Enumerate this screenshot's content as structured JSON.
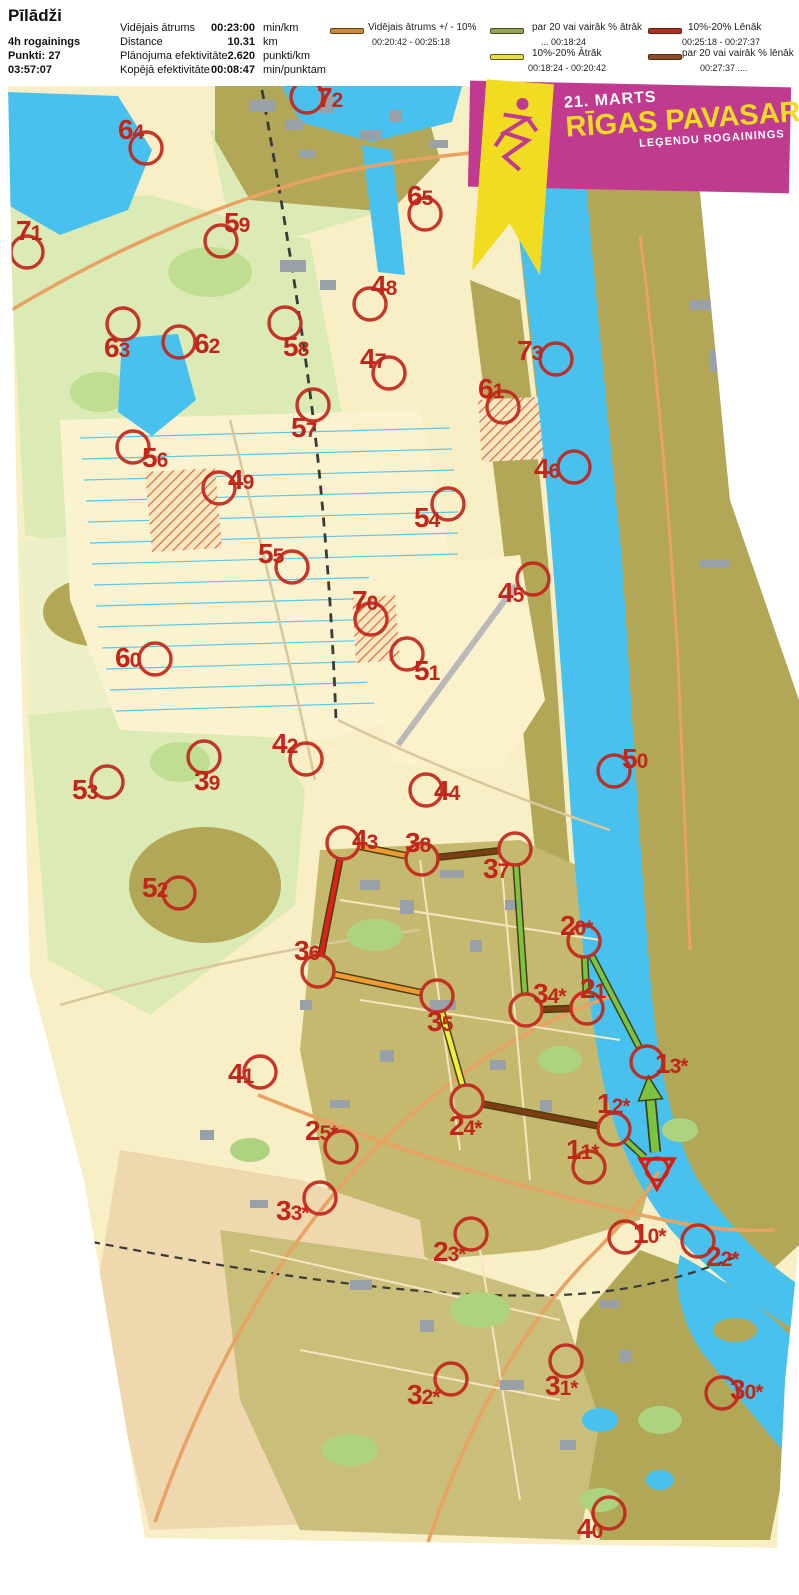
{
  "header": {
    "title": "Pīlādži",
    "left_lines": [
      "4h rogainings",
      "Punkti: 27",
      "03:57:07"
    ],
    "stats": [
      {
        "label": "Vidējais ātrums",
        "value": "00:23:00",
        "unit": "min/km"
      },
      {
        "label": "Distance",
        "value": "10.31",
        "unit": "km"
      },
      {
        "label": "Plānojuma efektivitāte",
        "value": "2.620",
        "unit": "punkti/km"
      },
      {
        "label": "Kopējā efektivitāte",
        "value": "00:08:47",
        "unit": "min/punktam"
      }
    ]
  },
  "legend": {
    "columns": [
      {
        "items": [
          {
            "color": "#C9893E",
            "label": "Vidējais ātrums +/ - 10%",
            "range": "00:20:42  -  00:25:18"
          }
        ]
      },
      {
        "items": [
          {
            "color": "#8FA55C",
            "label": "par 20 vai vairāk % ātrāk",
            "range": "...  00:18:24"
          },
          {
            "color": "#E3E04B",
            "label": "10%-20% Ātrāk",
            "range": "00:18:24  -  00:20:42"
          }
        ]
      },
      {
        "items": [
          {
            "color": "#B12B24",
            "label": "10%-20% Lēnāk",
            "range": "00:25:18  -  00:27:37"
          },
          {
            "color": "#8A4A28",
            "label": "par 20 vai vairāk % lēnāk",
            "range": "00:27:37  ...."
          }
        ]
      }
    ]
  },
  "banner": {
    "date": "21. MARTS",
    "title": "RĪGAS PAVASARA",
    "subtitle": "LEĢENDU ROGAININGS",
    "bg_color": "#C03A90",
    "accent_color": "#F2DC22"
  },
  "map": {
    "control_color": "#C1261B",
    "label_color": "#C2261A",
    "start": {
      "x": 657,
      "y": 1169
    },
    "controls": [
      {
        "n": "72",
        "x": 307,
        "y": 97,
        "lx": 317,
        "ly": 107
      },
      {
        "n": "64",
        "x": 146,
        "y": 148,
        "lx": 118,
        "ly": 139
      },
      {
        "n": "65",
        "x": 425,
        "y": 214,
        "lx": 407,
        "ly": 205
      },
      {
        "n": "71",
        "x": 27,
        "y": 252,
        "lx": 16,
        "ly": 240
      },
      {
        "n": "59",
        "x": 221,
        "y": 241,
        "lx": 224,
        "ly": 232
      },
      {
        "n": "48",
        "x": 370,
        "y": 304,
        "lx": 371,
        "ly": 295
      },
      {
        "n": "63",
        "x": 123,
        "y": 324,
        "lx": 104,
        "ly": 357
      },
      {
        "n": "62",
        "x": 179,
        "y": 342,
        "lx": 194,
        "ly": 353
      },
      {
        "n": "58",
        "x": 285,
        "y": 323,
        "lx": 283,
        "ly": 356
      },
      {
        "n": "73",
        "x": 556,
        "y": 359,
        "lx": 517,
        "ly": 360
      },
      {
        "n": "47",
        "x": 389,
        "y": 373,
        "lx": 360,
        "ly": 368
      },
      {
        "n": "57",
        "x": 313,
        "y": 405,
        "lx": 291,
        "ly": 437
      },
      {
        "n": "61",
        "x": 503,
        "y": 407,
        "lx": 478,
        "ly": 398
      },
      {
        "n": "56",
        "x": 133,
        "y": 447,
        "lx": 142,
        "ly": 467
      },
      {
        "n": "49",
        "x": 219,
        "y": 488,
        "lx": 228,
        "ly": 489
      },
      {
        "n": "46",
        "x": 574,
        "y": 467,
        "lx": 534,
        "ly": 478
      },
      {
        "n": "54",
        "x": 448,
        "y": 504,
        "lx": 414,
        "ly": 527
      },
      {
        "n": "55",
        "x": 292,
        "y": 567,
        "lx": 258,
        "ly": 563
      },
      {
        "n": "45",
        "x": 533,
        "y": 579,
        "lx": 498,
        "ly": 602
      },
      {
        "n": "70",
        "x": 371,
        "y": 619,
        "lx": 352,
        "ly": 610
      },
      {
        "n": "51",
        "x": 407,
        "y": 654,
        "lx": 414,
        "ly": 680
      },
      {
        "n": "60",
        "x": 155,
        "y": 659,
        "lx": 115,
        "ly": 667
      },
      {
        "n": "50",
        "x": 614,
        "y": 771,
        "lx": 622,
        "ly": 768
      },
      {
        "n": "42",
        "x": 306,
        "y": 759,
        "lx": 272,
        "ly": 753
      },
      {
        "n": "39",
        "x": 204,
        "y": 757,
        "lx": 194,
        "ly": 790
      },
      {
        "n": "44",
        "x": 426,
        "y": 790,
        "lx": 434,
        "ly": 800
      },
      {
        "n": "53",
        "x": 107,
        "y": 782,
        "lx": 72,
        "ly": 799
      },
      {
        "n": "43",
        "x": 343,
        "y": 843,
        "lx": 352,
        "ly": 849
      },
      {
        "n": "38",
        "x": 422,
        "y": 859,
        "lx": 405,
        "ly": 852
      },
      {
        "n": "37",
        "x": 515,
        "y": 849,
        "lx": 483,
        "ly": 878
      },
      {
        "n": "52",
        "x": 179,
        "y": 893,
        "lx": 142,
        "ly": 897
      },
      {
        "n": "36",
        "x": 318,
        "y": 971,
        "lx": 294,
        "ly": 960
      },
      {
        "n": "20*",
        "x": 584,
        "y": 941,
        "lx": 560,
        "ly": 935
      },
      {
        "n": "21",
        "x": 587,
        "y": 1008,
        "lx": 580,
        "ly": 998
      },
      {
        "n": "34*",
        "x": 526,
        "y": 1010,
        "lx": 533,
        "ly": 1003
      },
      {
        "n": "35",
        "x": 437,
        "y": 996,
        "lx": 427,
        "ly": 1031
      },
      {
        "n": "13*",
        "x": 647,
        "y": 1062,
        "lx": 655,
        "ly": 1073
      },
      {
        "n": "41",
        "x": 260,
        "y": 1072,
        "lx": 228,
        "ly": 1083
      },
      {
        "n": "25*",
        "x": 341,
        "y": 1147,
        "lx": 305,
        "ly": 1140
      },
      {
        "n": "24*",
        "x": 467,
        "y": 1101,
        "lx": 449,
        "ly": 1135
      },
      {
        "n": "12*",
        "x": 614,
        "y": 1129,
        "lx": 597,
        "ly": 1113
      },
      {
        "n": "11*",
        "x": 589,
        "y": 1167,
        "lx": 566,
        "ly": 1159
      },
      {
        "n": "33*",
        "x": 320,
        "y": 1198,
        "lx": 276,
        "ly": 1220
      },
      {
        "n": "23*",
        "x": 471,
        "y": 1234,
        "lx": 433,
        "ly": 1261
      },
      {
        "n": "10*",
        "x": 625,
        "y": 1237,
        "lx": 633,
        "ly": 1243
      },
      {
        "n": "22*",
        "x": 698,
        "y": 1241,
        "lx": 706,
        "ly": 1266
      },
      {
        "n": "31*",
        "x": 566,
        "y": 1361,
        "lx": 545,
        "ly": 1395
      },
      {
        "n": "32*",
        "x": 451,
        "y": 1379,
        "lx": 407,
        "ly": 1404
      },
      {
        "n": "30*",
        "x": 722,
        "y": 1393,
        "lx": 730,
        "ly": 1399
      },
      {
        "n": "40",
        "x": 609,
        "y": 1513,
        "lx": 577,
        "ly": 1538
      }
    ],
    "speed_colors": {
      "avg": "#F09A32",
      "fast20": "#7CC342",
      "fast10": "#F2EE3C",
      "slow10": "#E02018",
      "slow20": "#7E3D12"
    },
    "route_legs": [
      {
        "from": "start",
        "to": "13*",
        "speed": "fast20",
        "arrow": true,
        "thick": true
      },
      {
        "from": "13*",
        "to": "20*",
        "speed": "fast20"
      },
      {
        "from": "20*",
        "to": "21",
        "speed": "fast20"
      },
      {
        "from": "21",
        "to": "34*",
        "speed": "slow20"
      },
      {
        "from": "34*",
        "to": "37",
        "speed": "fast20"
      },
      {
        "from": "37",
        "to": "38",
        "speed": "slow20"
      },
      {
        "from": "38",
        "to": "43",
        "speed": "avg"
      },
      {
        "from": "43",
        "to": "36",
        "speed": "slow10"
      },
      {
        "from": "36",
        "to": "35",
        "speed": "avg"
      },
      {
        "from": "35",
        "to": "24*",
        "speed": "fast10"
      },
      {
        "from": "24*",
        "to": "12*",
        "speed": "slow20"
      },
      {
        "from": "12*",
        "to": "start",
        "speed": "fast20"
      }
    ]
  }
}
